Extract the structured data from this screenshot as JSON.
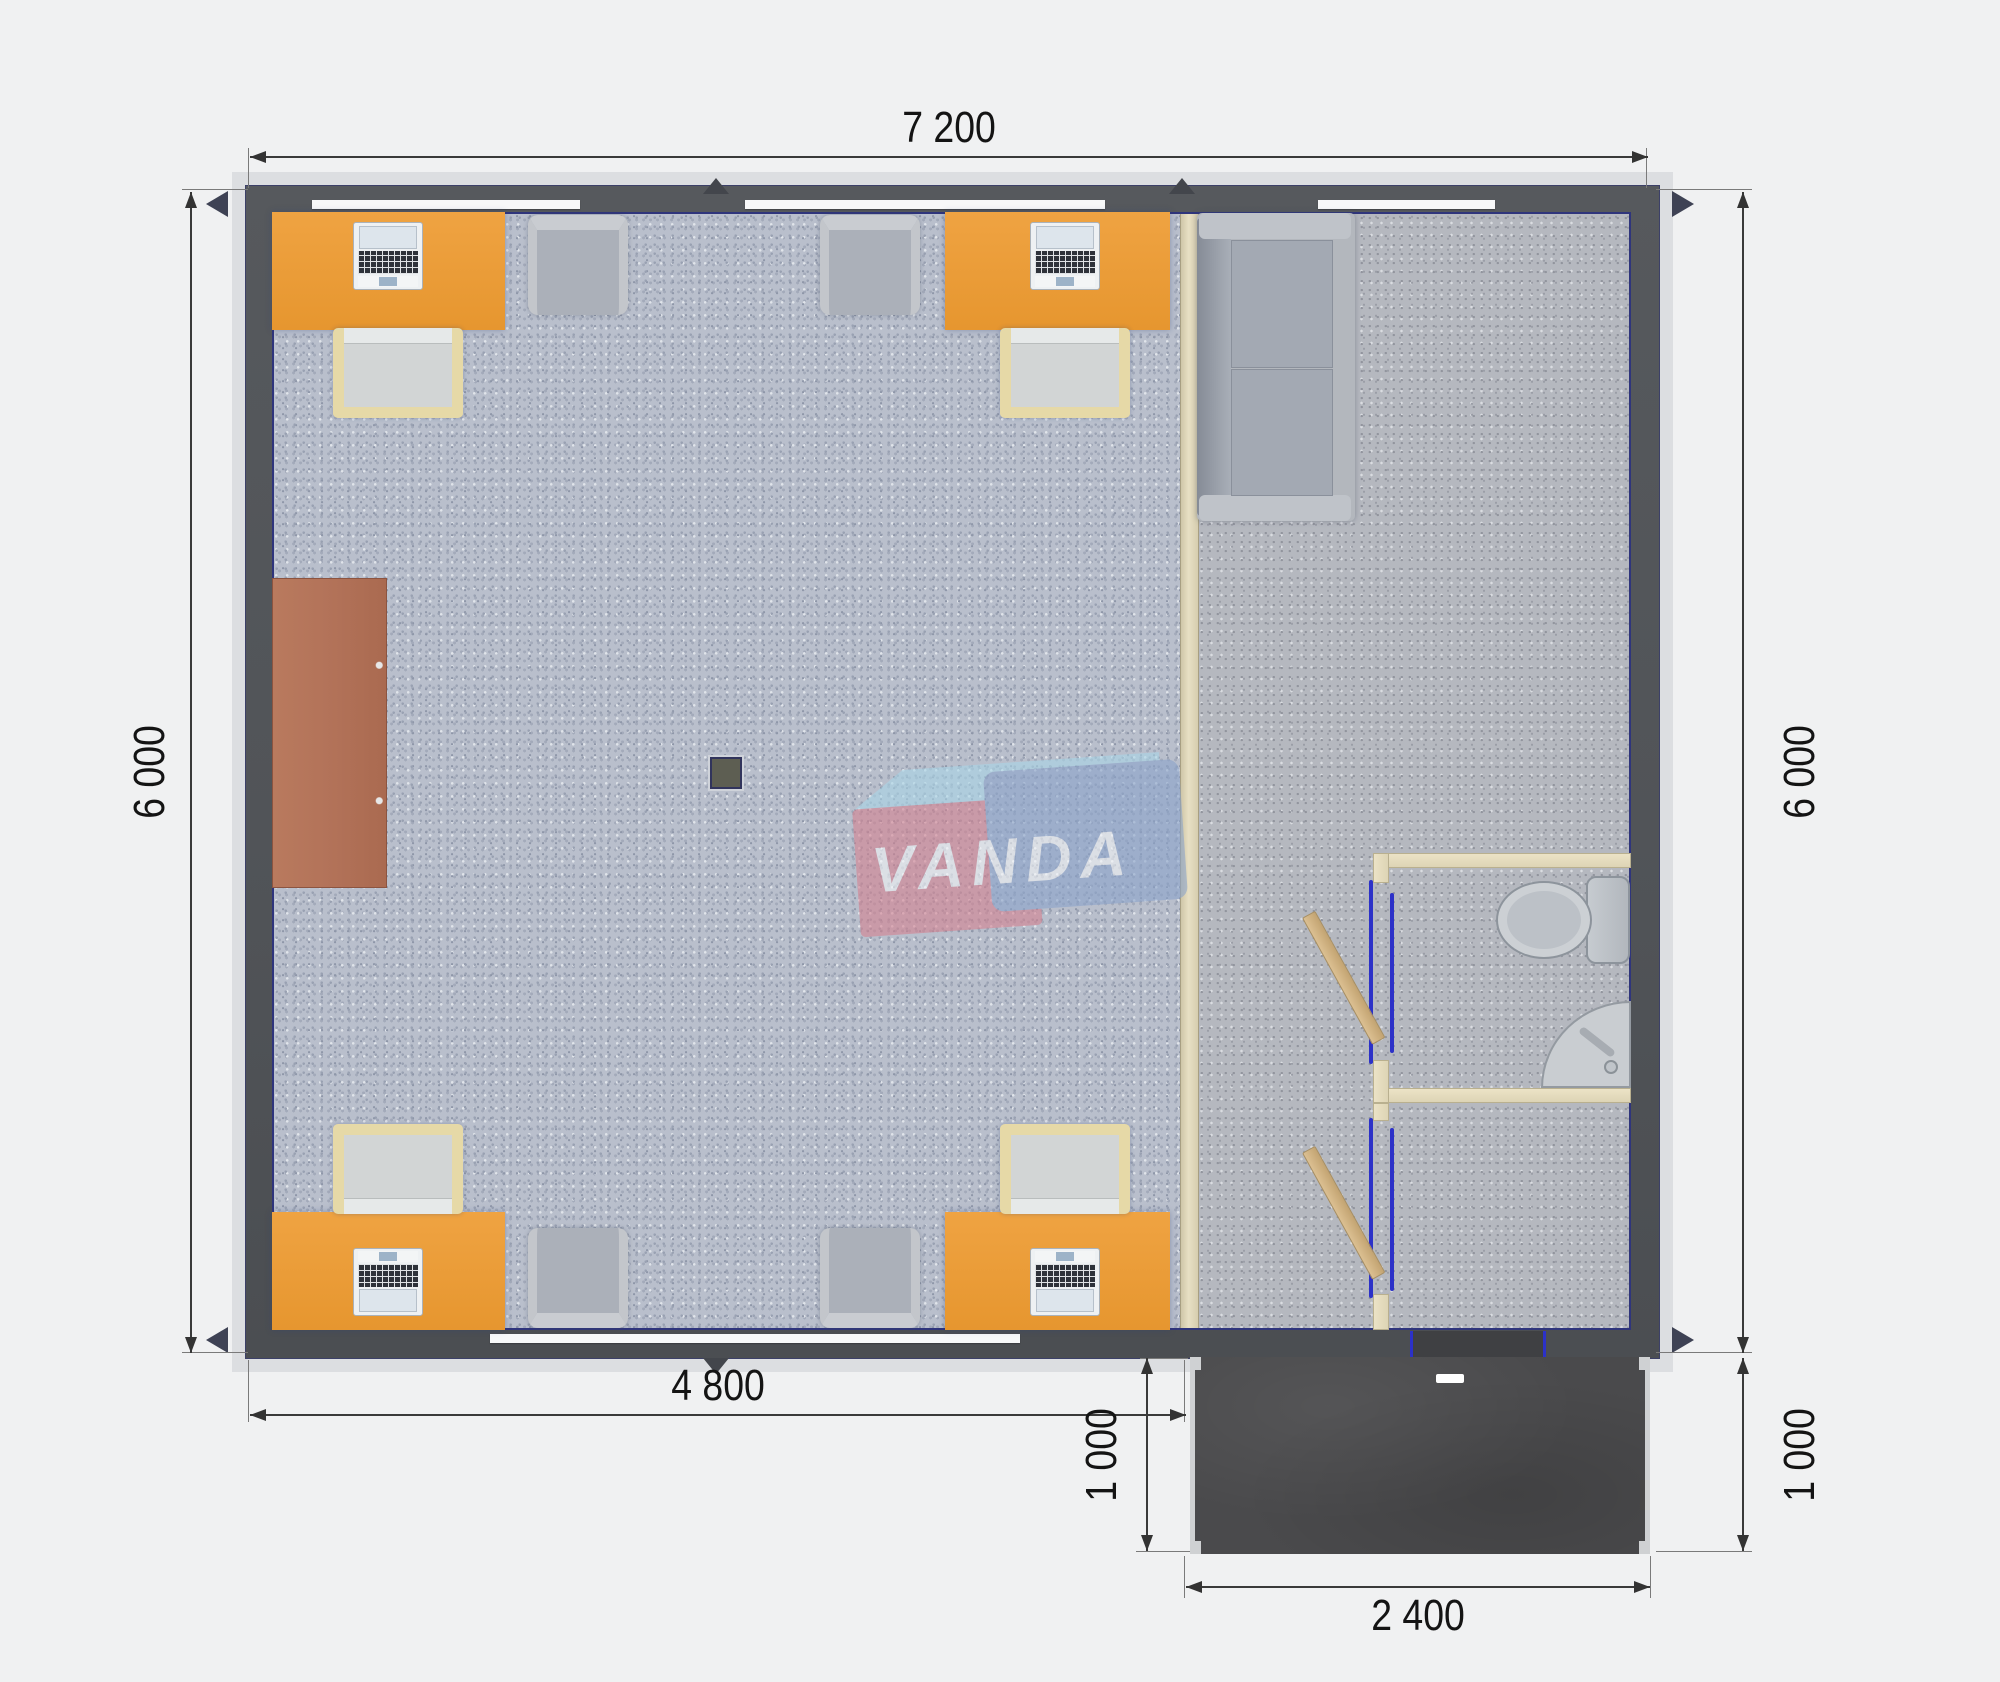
{
  "title": "Modular office floor plan render",
  "dimension_labels": {
    "top": "7 200",
    "left": "6 000",
    "right": "6 000",
    "bottom_main": "4 800",
    "porch_left": "1 000",
    "porch_right": "1 000",
    "porch_bottom": "2 400"
  },
  "watermark": {
    "text": "VANDA",
    "pink_box_color": "#d5808f",
    "blue_box_color": "#8aa3cb",
    "lightblue_bevel_color": "#a9d6e8",
    "text_color": "#f4f6f8"
  },
  "palette": {
    "background": "#f0f1f2",
    "exterior_wall": "#525559",
    "roof_edge": "#dcdee1",
    "office_floor": "#b9bfcc",
    "hall_floor": "#b5b8bf",
    "desk_orange": "#e99a38",
    "chair_frame_cream": "#e6d9a7",
    "armchair_gray": "#b4b8bf",
    "cabinet_brown": "#b3735a",
    "interior_wall_cream": "#e4dbbd",
    "door_frame_blue": "#2c31c8",
    "door_wood": "#d0b384",
    "porch_dark": "#4a4a4c",
    "dimension_text": "#141414"
  },
  "objects": {
    "office_desks": 4,
    "laptops": 4,
    "desk_chairs": 4,
    "armchairs": 4,
    "sofa": 1,
    "storage_cabinet": 1,
    "ceiling_column": 1,
    "toilet": 1,
    "corner_sink": 1,
    "interior_doors": 2,
    "entrance_door": 1,
    "porch": 1
  }
}
